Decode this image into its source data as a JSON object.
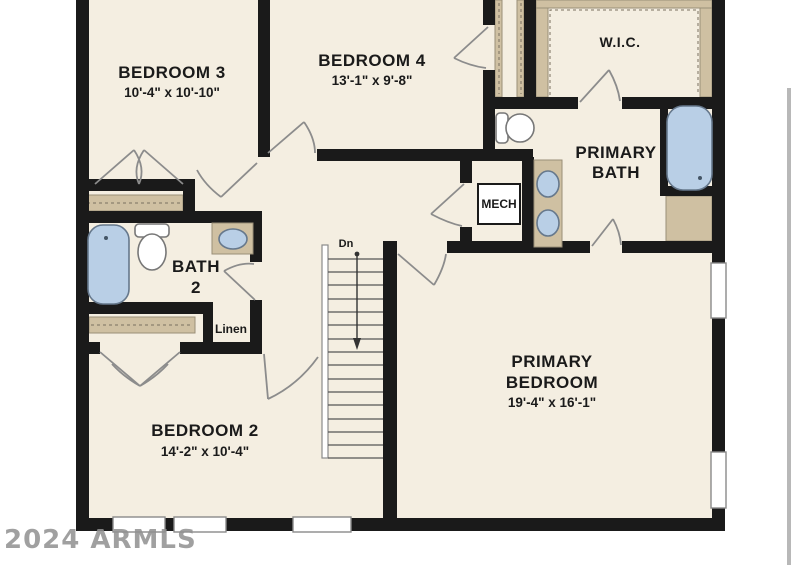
{
  "colors": {
    "wall": "#1a1a1a",
    "floor": "#f4eee1",
    "background": "#ffffff",
    "closet_shelf": "#cfc0a2",
    "shelf_line": "#9a8f78",
    "fixture_fill": "#b9cfe6",
    "fixture_outline": "#66788c",
    "door_line": "#8c8c8c",
    "watermark": "#909090",
    "artifact_line": "#b8b8b8",
    "text": "#1a1a1a"
  },
  "watermark": {
    "text": "2024 ARMLS"
  },
  "rooms": {
    "bedroom3": {
      "name": "BEDROOM 3",
      "dims": "10'-4\" x 10'-10\""
    },
    "bedroom4": {
      "name": "BEDROOM 4",
      "dims": "13'-1\" x 9'-8\""
    },
    "wic": {
      "name": "W.I.C."
    },
    "primary_bath": {
      "name_line1": "PRIMARY",
      "name_line2": "BATH"
    },
    "bath2": {
      "name_line1": "BATH",
      "name_line2": "2"
    },
    "bedroom2": {
      "name": "BEDROOM 2",
      "dims": "14'-2\" x 10'-4\""
    },
    "primary_bedroom": {
      "name_line1": "PRIMARY",
      "name_line2": "BEDROOM",
      "dims": "19'-4\" x 16'-1\""
    }
  },
  "closets": {
    "mech_label": "MECH",
    "linen_label": "Linen"
  },
  "stairs": {
    "down_label": "Dn"
  }
}
